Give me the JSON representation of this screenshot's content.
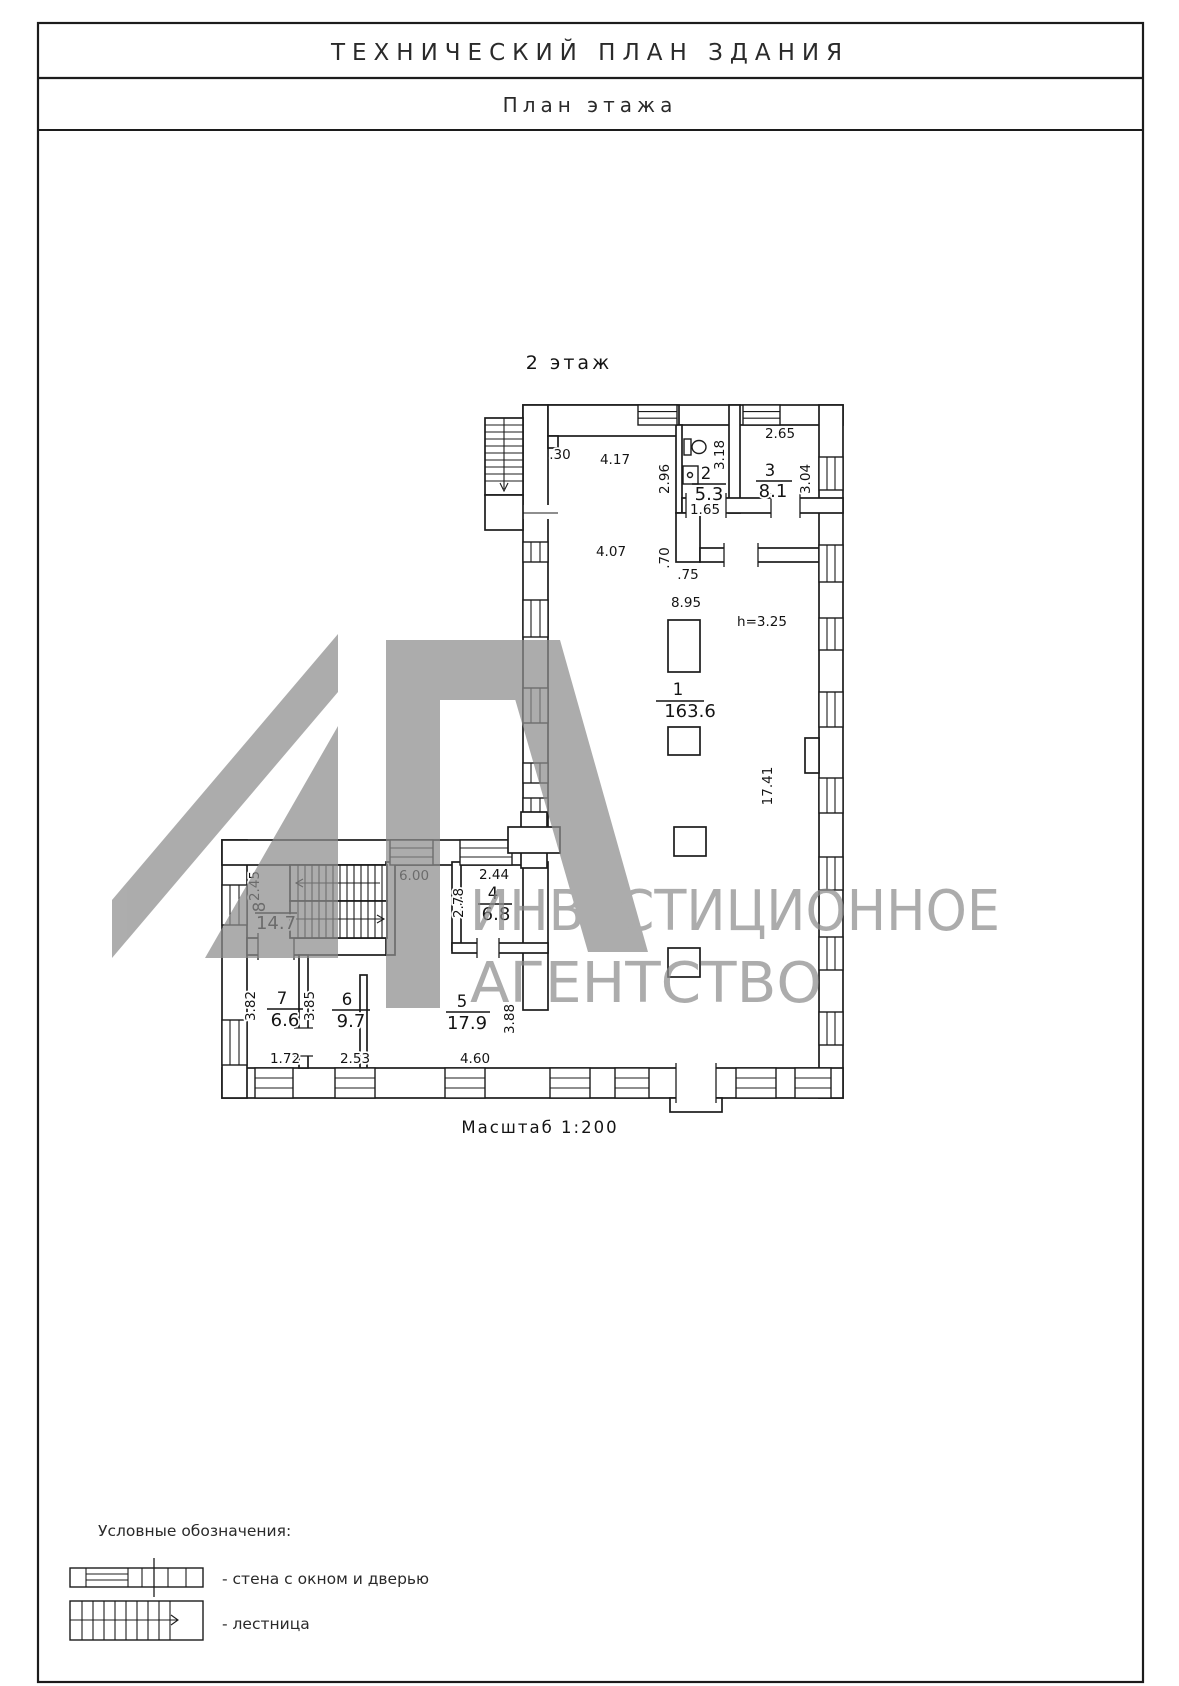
{
  "doc": {
    "title": "ТЕХНИЧЕСКИЙ ПЛАН ЗДАНИЯ",
    "subtitle": "План этажа",
    "floor_label": "2 этаж",
    "scale_label": "Масштаб 1:200",
    "height_note": "h=3.25"
  },
  "rooms": [
    {
      "num": "1",
      "area": "163.6"
    },
    {
      "num": "2",
      "area": "5.3"
    },
    {
      "num": "3",
      "area": "8.1"
    },
    {
      "num": "4",
      "area": "6.8"
    },
    {
      "num": "5",
      "area": "17.9"
    },
    {
      "num": "6",
      "area": "9.7"
    },
    {
      "num": "7",
      "area": "6.6"
    },
    {
      "num": "8",
      "area": "14.7"
    }
  ],
  "dims": [
    ".30",
    "4.17",
    "2.96",
    "3.18",
    "2.65",
    "3.04",
    "1.65",
    "4.07",
    ".70",
    ".75",
    "8.95",
    "17.41",
    "2.45",
    "6.00",
    "2.44",
    "2.78",
    "3.82",
    "3.85",
    "3.88",
    "1.72",
    "2.53",
    "4.60"
  ],
  "legend": {
    "heading": "Условные обозначения:",
    "items": [
      {
        "label": "-  стена с окном и дверью"
      },
      {
        "label": "-  лестница"
      }
    ]
  },
  "watermark": {
    "line1": "ИНВЕСТИЦИОННОЕ",
    "line2": "АГЕНТСТВО"
  }
}
